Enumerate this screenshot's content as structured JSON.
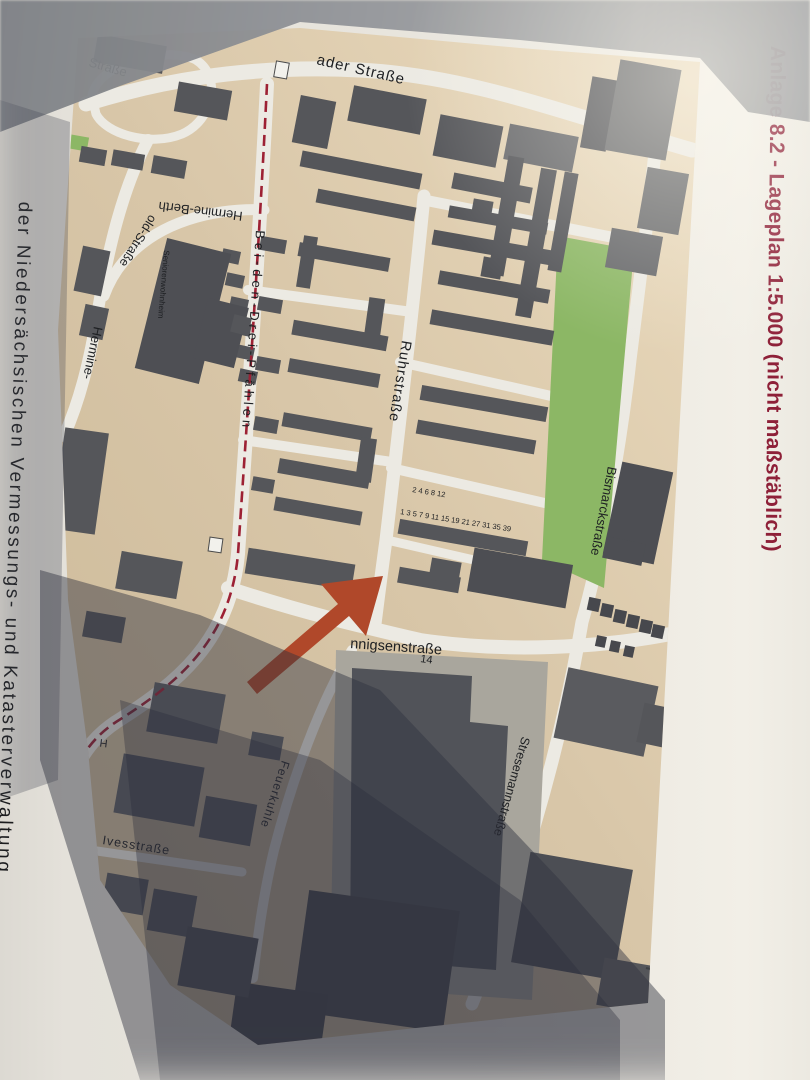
{
  "document": {
    "annex_title": "Anlage 8.2 - Lageplan 1:5.000 (nicht maßstäblich)",
    "annex_title_color": "#8e2038",
    "left_caption": "der Niedersächsischen Vermessungs- und Katasterverwaltung"
  },
  "map": {
    "streets": {
      "top_left": "Straße",
      "top": "ader Straße",
      "hermine_berth": "Hermine-Berth",
      "hermine_old": "old-Straße",
      "hermine_left": "Hermine-",
      "bei_den_drei_pfaehlen": "Bei-den-Drei-Pfählen",
      "ruhrstrasse": "Ruhrstraße",
      "bismarckstrasse": "Bismarckstraße",
      "stresemannstrasse": "Stresemannstraße",
      "hannigsenstrasse": "nnigsenstraße",
      "feuerkuhle": "Feuerkuhle",
      "ivesstrasse": "Ivesstraße",
      "edge_fragment": "H"
    },
    "poi": {
      "seniorenwohnheim": "Seniorenwohnheim"
    },
    "house_numbers": {
      "block_14": "14",
      "row_even": "2 4 6 8  12",
      "row_odd": "1 3 5 7 9 11 15 19 21 27 31 35 39"
    },
    "arrow_color": "#b0482a",
    "colors": {
      "land": "#d8c6a8",
      "road": "#eceae3",
      "building": "#55565a",
      "green_area": "#8cb765",
      "boundary_dash": "#9d2134"
    }
  }
}
